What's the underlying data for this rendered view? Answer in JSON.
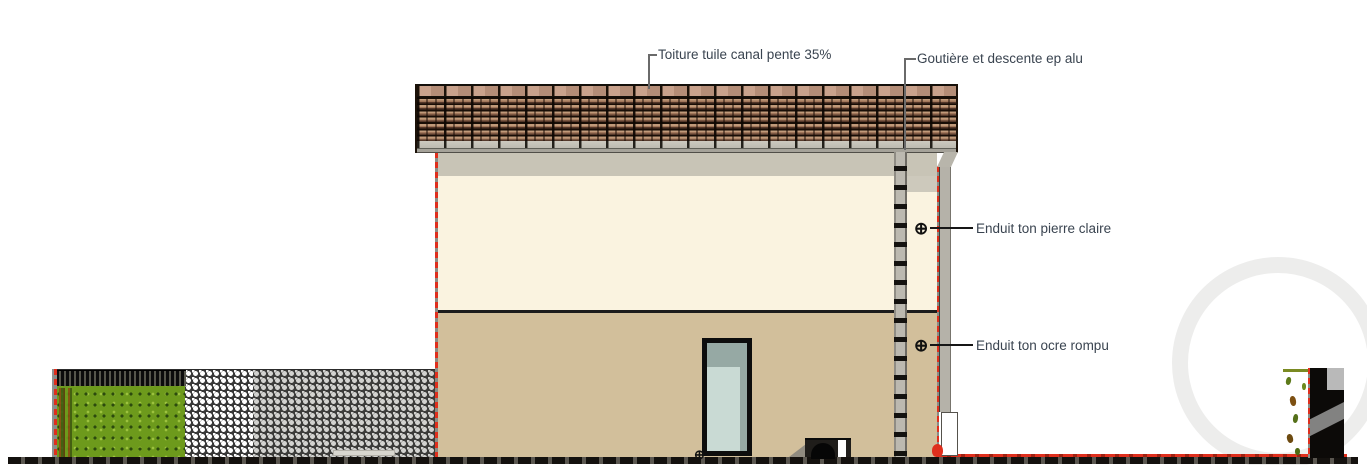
{
  "annotations": {
    "roof": "Toiture tuile canal pente 35%",
    "gutter": "Goutière et descente ep alu",
    "upper_wall": "Enduit ton pierre claire",
    "lower_wall": "Enduit ton ocre rompu"
  },
  "symbols": {
    "target": "⊕"
  },
  "colors": {
    "ink": "#3a4450",
    "leader": "#6a6a6a",
    "wall-upper": "#faf3e0",
    "wall-lower": "#d2bf9b",
    "eave-shadow": "#c8c4b6",
    "roof-dark": "#1c1209",
    "ridge-tile": "#c9a28c",
    "tile-face": "#c09a7a",
    "fascia": "#bdbab0",
    "gutter": "#a5a299",
    "pipe": "#bcb9b0",
    "glass": "#c9dad4",
    "glass-shade": "#96a9a4",
    "hedge-green": "#6d9a1c",
    "cut-red": "#df2f1d",
    "ground-dark": "#14110e"
  }
}
